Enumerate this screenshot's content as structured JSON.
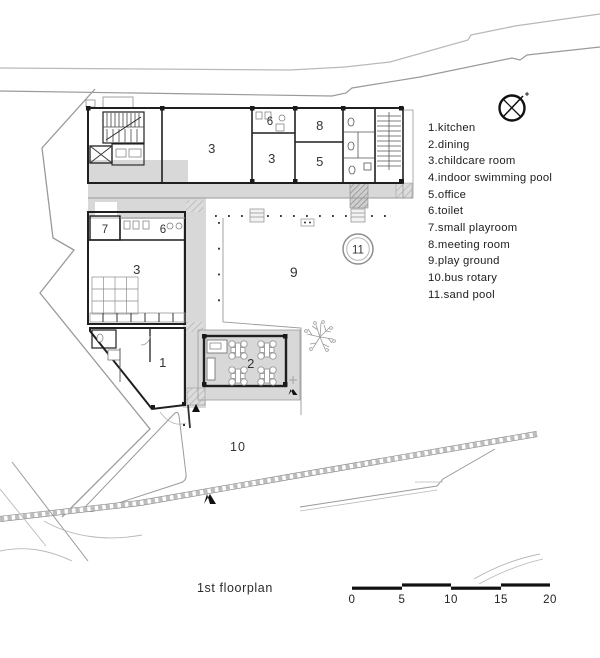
{
  "caption": "1st floorplan",
  "legend": {
    "items": [
      "1.kitchen",
      "2.dining",
      "3.childcare room",
      "4.indoor swimming pool",
      "5.office",
      "6.toilet",
      "7.small playroom",
      "8.meeting room",
      "9.play ground",
      "10.bus rotary",
      "11.sand pool"
    ]
  },
  "plan_labels": {
    "childcare_a": "3",
    "toilet_a": "6",
    "meeting": "8",
    "childcare_b": "3",
    "office": "5",
    "playroom": "7",
    "toilet_b": "6",
    "childcare_c": "3",
    "kitchen": "1",
    "dining": "2",
    "playground": "9",
    "bus_rotary": "10",
    "sand_pool": "11"
  },
  "scale_bar": {
    "ticks": [
      "0",
      "5",
      "10",
      "15",
      "20"
    ]
  },
  "icons": {
    "north_indicator": "compass-circle-with-cross"
  },
  "colors": {
    "wall": "#1f1f1f",
    "corridor_gray": "#d8d8d8",
    "contour_light": "#c8c8c8",
    "contour_dark": "#8f8f8f",
    "scalebar_black": "#111111"
  }
}
